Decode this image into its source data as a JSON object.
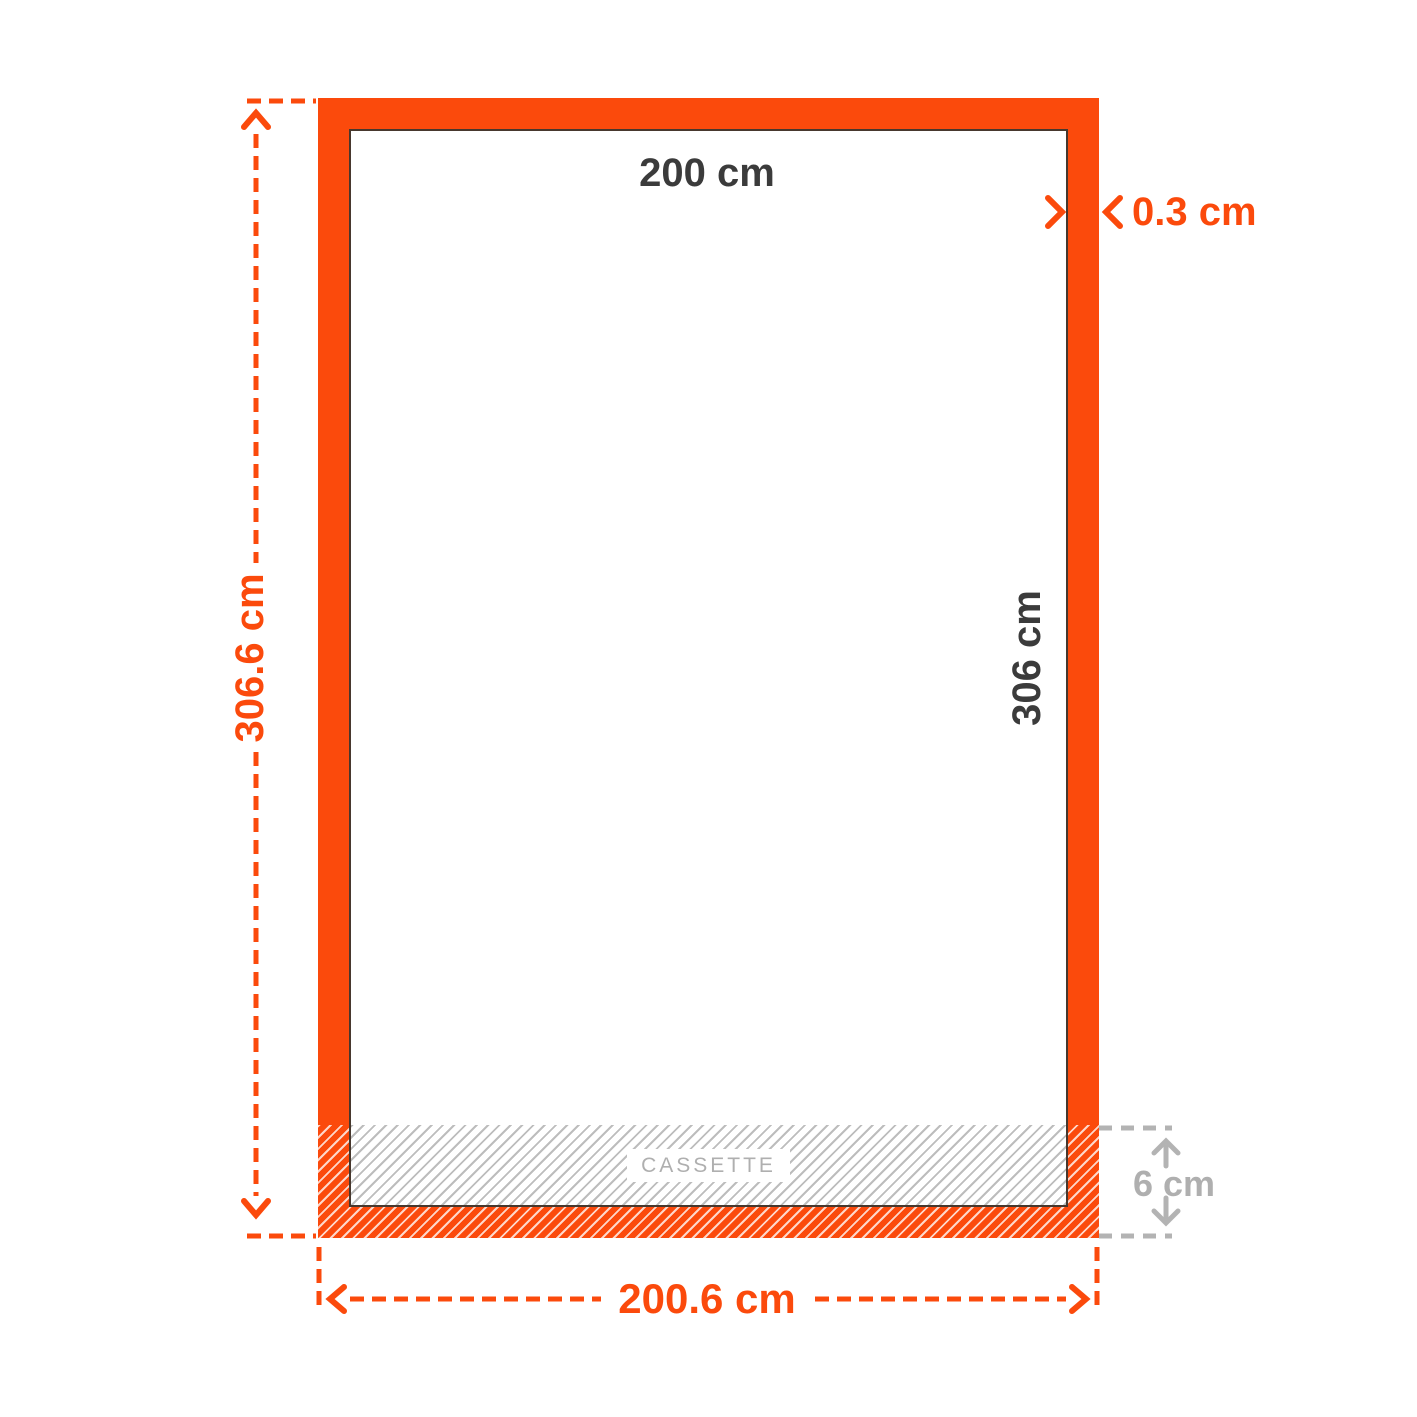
{
  "diagram": {
    "frame": {
      "inner_width_label": "200 cm",
      "inner_height_label": "306 cm",
      "border_thickness_label": "0.3 cm",
      "outer_height_label": "306.6 cm",
      "outer_width_label": "200.6 cm",
      "cassette_label": "CASSETTE",
      "cassette_height_label": "6 cm"
    },
    "colors": {
      "accent_orange": "#FB4A0C",
      "dark_text": "#3B3B3B",
      "gray_text": "#AFAFAF",
      "gray_line": "#B3B3B3",
      "hatch_gray": "#BDBDBD",
      "frame_edge": "#47382E"
    }
  }
}
